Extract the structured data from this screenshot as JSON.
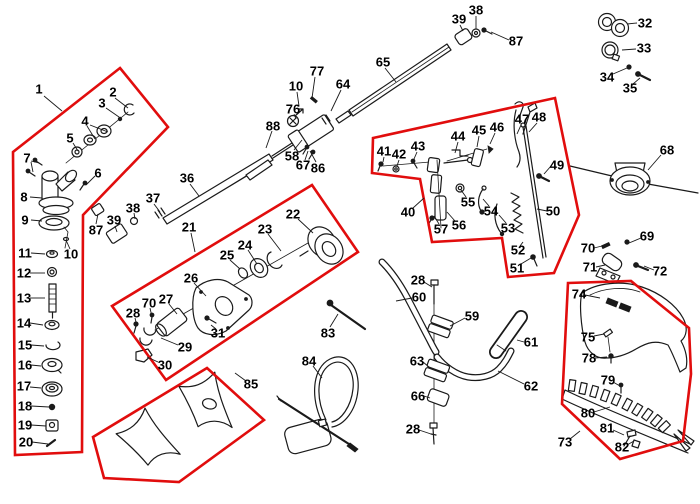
{
  "figure": {
    "type": "exploded-parts-diagram",
    "description": "Brushcutter / string trimmer exploded view with numbered part callouts and red highlighted assembly groups",
    "background": "#ffffff"
  },
  "colors": {
    "red": "#e10d0d",
    "ink": "#1a1a1a",
    "label": "#000000"
  },
  "diagram": {
    "regions": [
      {
        "name": "gear-head-group",
        "points": "120,68 168,127 83,215 82,452 15,455 13,152"
      },
      {
        "name": "clutch-case-group",
        "points": "112,306 312,185 358,252 166,380"
      },
      {
        "name": "throttle-group",
        "points": "373,138 555,98 579,215 554,273 508,277 502,238 432,242 420,179 372,173"
      },
      {
        "name": "blade-group",
        "points": "207,368 264,420 179,482 104,478 93,437"
      },
      {
        "name": "guard-group",
        "points": "568,283 631,281 689,328 691,374 683,441 620,459 562,404"
      }
    ],
    "labels": [
      {
        "t": "1",
        "x": 39,
        "y": 89
      },
      {
        "t": "2",
        "x": 113,
        "y": 92
      },
      {
        "t": "3",
        "x": 102,
        "y": 103
      },
      {
        "t": "4",
        "x": 85,
        "y": 121
      },
      {
        "t": "5",
        "x": 70,
        "y": 138
      },
      {
        "t": "6",
        "x": 98,
        "y": 173
      },
      {
        "t": "7",
        "x": 27,
        "y": 158
      },
      {
        "t": "8",
        "x": 24,
        "y": 197
      },
      {
        "t": "9",
        "x": 25,
        "y": 220
      },
      {
        "t": "10",
        "x": 71,
        "y": 254
      },
      {
        "t": "11",
        "x": 25,
        "y": 253
      },
      {
        "t": "12",
        "x": 24,
        "y": 273
      },
      {
        "t": "13",
        "x": 24,
        "y": 298
      },
      {
        "t": "14",
        "x": 24,
        "y": 323
      },
      {
        "t": "15",
        "x": 25,
        "y": 345
      },
      {
        "t": "16",
        "x": 25,
        "y": 365
      },
      {
        "t": "17",
        "x": 24,
        "y": 386
      },
      {
        "t": "18",
        "x": 25,
        "y": 406
      },
      {
        "t": "19",
        "x": 25,
        "y": 425
      },
      {
        "t": "20",
        "x": 26,
        "y": 442
      },
      {
        "t": "87",
        "x": 96,
        "y": 230
      },
      {
        "t": "39",
        "x": 114,
        "y": 220
      },
      {
        "t": "38",
        "x": 133,
        "y": 208
      },
      {
        "t": "37",
        "x": 153,
        "y": 198
      },
      {
        "t": "36",
        "x": 187,
        "y": 178
      },
      {
        "t": "21",
        "x": 189,
        "y": 227
      },
      {
        "t": "22",
        "x": 293,
        "y": 214
      },
      {
        "t": "23",
        "x": 265,
        "y": 229
      },
      {
        "t": "24",
        "x": 245,
        "y": 245
      },
      {
        "t": "25",
        "x": 227,
        "y": 255
      },
      {
        "t": "26",
        "x": 191,
        "y": 278
      },
      {
        "t": "27",
        "x": 166,
        "y": 299
      },
      {
        "t": "70",
        "x": 149,
        "y": 303
      },
      {
        "t": "28",
        "x": 133,
        "y": 313
      },
      {
        "t": "29",
        "x": 185,
        "y": 347
      },
      {
        "t": "30",
        "x": 165,
        "y": 365
      },
      {
        "t": "31",
        "x": 218,
        "y": 333
      },
      {
        "t": "83",
        "x": 328,
        "y": 333
      },
      {
        "t": "84",
        "x": 309,
        "y": 361
      },
      {
        "t": "85",
        "x": 251,
        "y": 384
      },
      {
        "t": "88",
        "x": 273,
        "y": 126
      },
      {
        "t": "76",
        "x": 293,
        "y": 109
      },
      {
        "t": "58",
        "x": 292,
        "y": 156
      },
      {
        "t": "67",
        "x": 303,
        "y": 165
      },
      {
        "t": "86",
        "x": 318,
        "y": 168
      },
      {
        "t": "77",
        "x": 317,
        "y": 71
      },
      {
        "t": "10",
        "x": 296,
        "y": 86
      },
      {
        "t": "64",
        "x": 343,
        "y": 84
      },
      {
        "t": "65",
        "x": 383,
        "y": 62
      },
      {
        "t": "39",
        "x": 459,
        "y": 19
      },
      {
        "t": "38",
        "x": 476,
        "y": 10
      },
      {
        "t": "87",
        "x": 516,
        "y": 41
      },
      {
        "t": "32",
        "x": 645,
        "y": 23
      },
      {
        "t": "33",
        "x": 644,
        "y": 48
      },
      {
        "t": "34",
        "x": 607,
        "y": 77
      },
      {
        "t": "35",
        "x": 630,
        "y": 88
      },
      {
        "t": "41",
        "x": 384,
        "y": 151
      },
      {
        "t": "42",
        "x": 399,
        "y": 154
      },
      {
        "t": "43",
        "x": 418,
        "y": 146
      },
      {
        "t": "44",
        "x": 458,
        "y": 136
      },
      {
        "t": "45",
        "x": 479,
        "y": 130
      },
      {
        "t": "46",
        "x": 497,
        "y": 127
      },
      {
        "t": "47",
        "x": 522,
        "y": 119
      },
      {
        "t": "48",
        "x": 539,
        "y": 117
      },
      {
        "t": "49",
        "x": 557,
        "y": 165
      },
      {
        "t": "50",
        "x": 553,
        "y": 211
      },
      {
        "t": "51",
        "x": 517,
        "y": 268
      },
      {
        "t": "52",
        "x": 518,
        "y": 250
      },
      {
        "t": "53",
        "x": 508,
        "y": 228
      },
      {
        "t": "54",
        "x": 491,
        "y": 211
      },
      {
        "t": "55",
        "x": 468,
        "y": 202
      },
      {
        "t": "56",
        "x": 459,
        "y": 225
      },
      {
        "t": "57",
        "x": 441,
        "y": 229
      },
      {
        "t": "40",
        "x": 408,
        "y": 212
      },
      {
        "t": "28",
        "x": 418,
        "y": 280
      },
      {
        "t": "60",
        "x": 419,
        "y": 297
      },
      {
        "t": "59",
        "x": 472,
        "y": 316
      },
      {
        "t": "61",
        "x": 531,
        "y": 342
      },
      {
        "t": "62",
        "x": 531,
        "y": 386
      },
      {
        "t": "63",
        "x": 417,
        "y": 361
      },
      {
        "t": "66",
        "x": 418,
        "y": 396
      },
      {
        "t": "28",
        "x": 413,
        "y": 429
      },
      {
        "t": "68",
        "x": 667,
        "y": 150
      },
      {
        "t": "69",
        "x": 647,
        "y": 236
      },
      {
        "t": "70",
        "x": 588,
        "y": 248
      },
      {
        "t": "71",
        "x": 590,
        "y": 267
      },
      {
        "t": "72",
        "x": 660,
        "y": 271
      },
      {
        "t": "74",
        "x": 579,
        "y": 294
      },
      {
        "t": "75",
        "x": 588,
        "y": 337
      },
      {
        "t": "78",
        "x": 589,
        "y": 358
      },
      {
        "t": "79",
        "x": 608,
        "y": 380
      },
      {
        "t": "80",
        "x": 588,
        "y": 413
      },
      {
        "t": "81",
        "x": 607,
        "y": 428
      },
      {
        "t": "82",
        "x": 622,
        "y": 447
      },
      {
        "t": "73",
        "x": 565,
        "y": 442
      }
    ],
    "leaders": [
      [
        44,
        96,
        62,
        111
      ],
      [
        115,
        98,
        128,
        108
      ],
      [
        106,
        108,
        119,
        117
      ],
      [
        87,
        126,
        95,
        139
      ],
      [
        90,
        125,
        108,
        132
      ],
      [
        73,
        143,
        78,
        151
      ],
      [
        95,
        176,
        86,
        185
      ],
      [
        31,
        161,
        39,
        163
      ],
      [
        31,
        162,
        33,
        172
      ],
      [
        30,
        197,
        42,
        198
      ],
      [
        31,
        220,
        42,
        221
      ],
      [
        70,
        249,
        66,
        240
      ],
      [
        31,
        253,
        45,
        254
      ],
      [
        30,
        273,
        45,
        273
      ],
      [
        30,
        298,
        45,
        298
      ],
      [
        30,
        323,
        43,
        325
      ],
      [
        31,
        345,
        44,
        346
      ],
      [
        31,
        365,
        41,
        366
      ],
      [
        30,
        387,
        41,
        388
      ],
      [
        31,
        406,
        49,
        407
      ],
      [
        31,
        425,
        46,
        426
      ],
      [
        32,
        442,
        48,
        444
      ],
      [
        96,
        224,
        98,
        214
      ],
      [
        115,
        226,
        117,
        232
      ],
      [
        134,
        213,
        135,
        219
      ],
      [
        154,
        204,
        160,
        212
      ],
      [
        190,
        184,
        199,
        196
      ],
      [
        191,
        233,
        195,
        252
      ],
      [
        298,
        219,
        313,
        233
      ],
      [
        268,
        234,
        281,
        251
      ],
      [
        248,
        250,
        257,
        264
      ],
      [
        230,
        260,
        240,
        269
      ],
      [
        194,
        283,
        206,
        296
      ],
      [
        169,
        304,
        177,
        314
      ],
      [
        150,
        308,
        152,
        317
      ],
      [
        135,
        318,
        137,
        326
      ],
      [
        178,
        345,
        161,
        338
      ],
      [
        158,
        362,
        147,
        357
      ],
      [
        216,
        329,
        211,
        325
      ],
      [
        330,
        327,
        338,
        314
      ],
      [
        313,
        366,
        322,
        378
      ],
      [
        246,
        381,
        235,
        373
      ],
      [
        272,
        131,
        266,
        148
      ],
      [
        294,
        114,
        296,
        119
      ],
      [
        294,
        150,
        302,
        140
      ],
      [
        305,
        160,
        308,
        151
      ],
      [
        316,
        162,
        310,
        151
      ],
      [
        315,
        77,
        312,
        98
      ],
      [
        297,
        92,
        299,
        106
      ],
      [
        341,
        90,
        331,
        111
      ],
      [
        385,
        68,
        396,
        82
      ],
      [
        460,
        25,
        463,
        31
      ],
      [
        476,
        16,
        476,
        29
      ],
      [
        509,
        40,
        491,
        32
      ],
      [
        637,
        23,
        627,
        24
      ],
      [
        636,
        49,
        622,
        50
      ],
      [
        613,
        74,
        627,
        68
      ],
      [
        633,
        84,
        640,
        78
      ],
      [
        384,
        157,
        383,
        162
      ],
      [
        399,
        160,
        397,
        166
      ],
      [
        417,
        152,
        414,
        159
      ],
      [
        458,
        142,
        455,
        153
      ],
      [
        479,
        136,
        477,
        147
      ],
      [
        495,
        133,
        490,
        144
      ],
      [
        521,
        125,
        517,
        134
      ],
      [
        537,
        123,
        529,
        132
      ],
      [
        551,
        166,
        544,
        174
      ],
      [
        547,
        211,
        537,
        209
      ],
      [
        521,
        264,
        531,
        258
      ],
      [
        520,
        246,
        523,
        242
      ],
      [
        506,
        223,
        499,
        215
      ],
      [
        489,
        206,
        483,
        199
      ],
      [
        466,
        197,
        461,
        190
      ],
      [
        455,
        221,
        447,
        212
      ],
      [
        439,
        224,
        434,
        216
      ],
      [
        413,
        208,
        424,
        198
      ],
      [
        424,
        282,
        432,
        287
      ],
      [
        412,
        298,
        396,
        301
      ],
      [
        465,
        318,
        450,
        326
      ],
      [
        524,
        342,
        517,
        340
      ],
      [
        524,
        384,
        498,
        371
      ],
      [
        423,
        362,
        429,
        367
      ],
      [
        424,
        396,
        430,
        398
      ],
      [
        419,
        430,
        431,
        434
      ],
      [
        661,
        155,
        648,
        170
      ],
      [
        641,
        238,
        629,
        243
      ],
      [
        594,
        248,
        602,
        246
      ],
      [
        596,
        267,
        605,
        265
      ],
      [
        654,
        270,
        644,
        266
      ],
      [
        585,
        295,
        600,
        298
      ],
      [
        594,
        336,
        604,
        334
      ],
      [
        595,
        358,
        607,
        357
      ],
      [
        613,
        382,
        620,
        386
      ],
      [
        594,
        412,
        610,
        407
      ],
      [
        613,
        430,
        624,
        435
      ],
      [
        627,
        445,
        634,
        441
      ],
      [
        570,
        439,
        580,
        431
      ]
    ]
  }
}
